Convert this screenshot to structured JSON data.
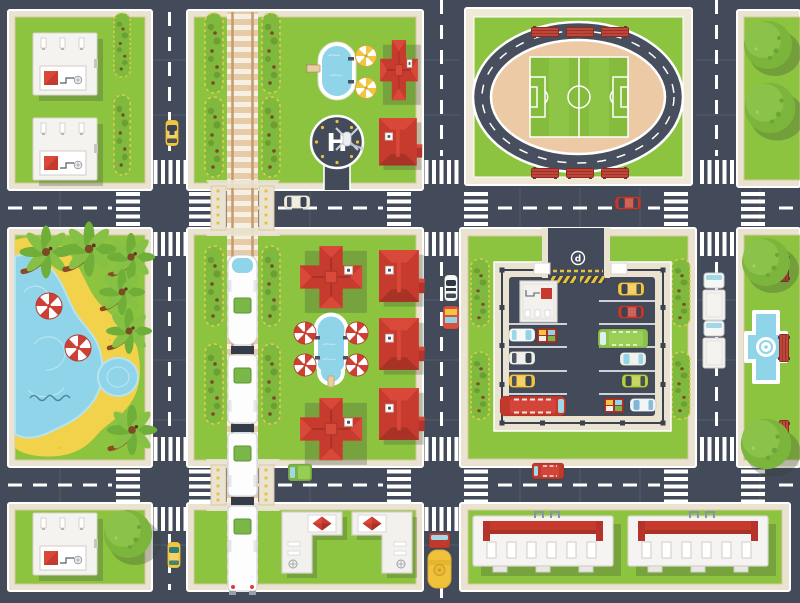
{
  "title": "City map top view — flat illustration poster",
  "labels": {
    "helipad_letter": "H",
    "parking_sign_letter": "d"
  },
  "palette": {
    "road": "#434a5a",
    "roadSeam": "#4d5565",
    "marking": "#ffffff",
    "laneYellow": "#e8c23a",
    "sidewalk": "#eae3d2",
    "sidewalkEdge": "#d9c7a3",
    "grass": "#8cc43f",
    "grassShadow": "#79ad36",
    "treeGreen": "#7cb53c",
    "treeLight": "#8ac24a",
    "hedgeGreen": "#7fb93d",
    "hedgeOutline": "#e0cc50",
    "hedgeBrown": "#7b4a26",
    "roofRed": "#c63b2e",
    "roofRedLight": "#d8493a",
    "roofRedDark": "#a93226",
    "buildingWhite": "#f4f3f0",
    "buildingBorder": "#d8d4cd",
    "water": "#8fd4e8",
    "waterLight": "#b8e4f0",
    "sand": "#f2d24b",
    "trackTan": "#e6cba6",
    "trackSleeper": "#f7f3ea",
    "railBrown": "#c49a6e",
    "trainGreen": "#7ab648",
    "benchRed": "#b23a2c",
    "infield": "#eccaa6",
    "taxiYellow": "#f2c541",
    "carRed": "#c0392b",
    "busGreen": "#8bc34a",
    "fenceDark": "#3a414f"
  },
  "features": [
    "stadium-running-track",
    "soccer-field",
    "stadium-benches",
    "public-swimming-pool",
    "courtyard-pool",
    "helipad",
    "railway-line",
    "passenger-train",
    "level-crossings",
    "parking-lot",
    "parking-entrance-sign",
    "beach-lagoon",
    "palm-trees",
    "beach-umbrellas",
    "fountain-plaza",
    "plaza-benches",
    "round-trees",
    "red-roof-houses",
    "white-office-buildings",
    "l-shaped-buildings",
    "warehouses",
    "hedgerows",
    "crosswalks",
    "dashed-lane-lines"
  ],
  "blocks": [
    {
      "id": "top-left",
      "content": "two white flat-roof buildings with red skylights, hedgerow"
    },
    {
      "id": "top-center",
      "content": "railway, hedges, swimming pool with two yellow umbrellas, two red houses, helipad"
    },
    {
      "id": "top-right",
      "content": "stadium: oval running track, soccer field, six benches"
    },
    {
      "id": "top-far-right",
      "content": "two round trees"
    },
    {
      "id": "mid-left",
      "content": "beach with lagoon, sand, pond, six palms, two red-white umbrellas"
    },
    {
      "id": "mid-center",
      "content": "two large cross houses, three small houses, courtyard pool with four umbrellas, hedges"
    },
    {
      "id": "mid-right",
      "content": "fenced parking lot with 12 vehicles, kiosk building, hedges"
    },
    {
      "id": "mid-far-right",
      "content": "fountain plaza, three benches, two round trees"
    },
    {
      "id": "bottom-left",
      "content": "white flat-roof building, round tree"
    },
    {
      "id": "bottom-center",
      "content": "two mirrored L-shaped buildings with red pyramid skylights"
    },
    {
      "id": "bottom-right",
      "content": "two long warehouses with red roof bars"
    }
  ],
  "vehicles_on_roads": [
    {
      "name": "taxi",
      "color": "yellow",
      "location": "left road, north"
    },
    {
      "name": "taxi",
      "color": "yellow",
      "location": "left road, south"
    },
    {
      "name": "sedan",
      "color": "white",
      "location": "top road, west"
    },
    {
      "name": "sedan",
      "color": "red",
      "location": "top road, east"
    },
    {
      "name": "police-car",
      "color": "white",
      "location": "center road"
    },
    {
      "name": "food-truck",
      "color": "red-yellow",
      "location": "center road"
    },
    {
      "name": "minibus",
      "color": "red",
      "location": "bottom road"
    },
    {
      "name": "camper-van",
      "color": "green",
      "location": "bottom road, west"
    },
    {
      "name": "tanker-truck",
      "color": "red-yellow",
      "location": "center road, south"
    },
    {
      "name": "cargo-truck",
      "color": "white",
      "location": "right road, parked"
    },
    {
      "name": "cargo-truck",
      "color": "white",
      "location": "right road, parked"
    },
    {
      "name": "passenger-train",
      "color": "white-green",
      "location": "railway, 4 cars"
    }
  ],
  "parking_lot_vehicles": [
    {
      "name": "delivery-van",
      "color": "white"
    },
    {
      "name": "crate-truck",
      "color": "multicolor"
    },
    {
      "name": "car",
      "color": "white"
    },
    {
      "name": "taxi",
      "color": "yellow"
    },
    {
      "name": "bus",
      "color": "red"
    },
    {
      "name": "taxi",
      "color": "yellow"
    },
    {
      "name": "car",
      "color": "red"
    },
    {
      "name": "bus",
      "color": "green"
    },
    {
      "name": "car",
      "color": "white"
    },
    {
      "name": "car",
      "color": "lime"
    },
    {
      "name": "crate-truck",
      "color": "multicolor"
    },
    {
      "name": "car",
      "color": "white-blue"
    }
  ],
  "counts": {
    "houses_red_roof": 7,
    "white_buildings": 3,
    "warehouses": 2,
    "l_shaped_buildings": 2,
    "palm_trees": 6,
    "round_trees": 6,
    "beach_umbrellas": 2,
    "pool_umbrellas_yellow": 2,
    "courtyard_umbrellas": 4,
    "stadium_benches": 6,
    "plaza_benches": 3,
    "train_cars": 4,
    "parked_lot_vehicles": 12,
    "hedgerow_segments": 16
  }
}
